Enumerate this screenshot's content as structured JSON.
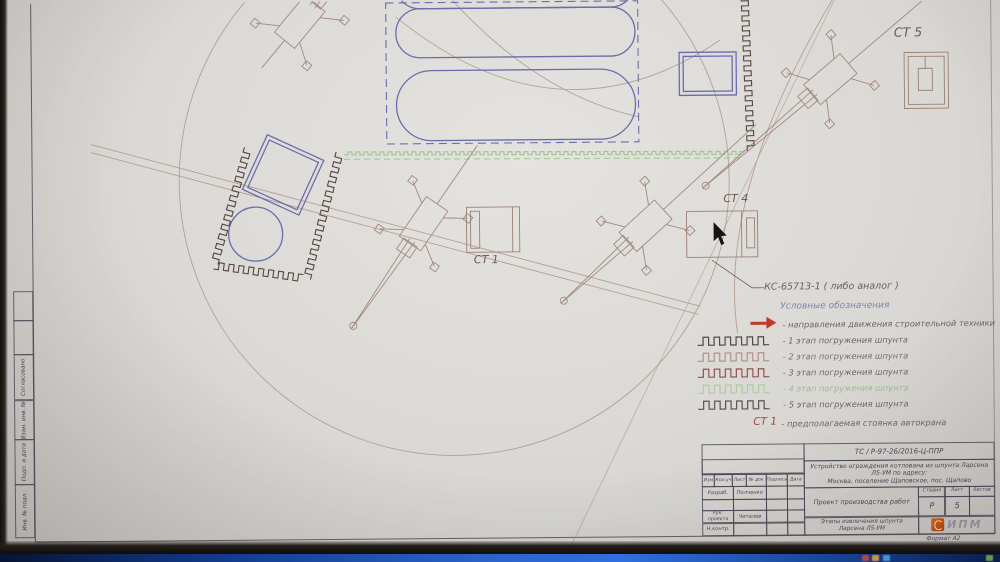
{
  "stations": {
    "st1": "СТ 1",
    "st4": "СТ 4",
    "st5": "СТ 5"
  },
  "crane_callout": "КС-65713-1 ( либо аналог )",
  "legend": {
    "title": "Условные обозначения",
    "direction_label": "- направления движения строительной техники",
    "items": [
      {
        "label": "- 1 этап погружения шпунта",
        "color": "#4f4a47"
      },
      {
        "label": "- 2 этап погружения шпунта",
        "color": "#b5908c"
      },
      {
        "label": "- 3 этап погружения шпунта",
        "color": "#935252"
      },
      {
        "label": "- 4 этап погружения шпунта",
        "color": "#aecba4"
      },
      {
        "label": "- 5 этап погружения шпунта",
        "color": "#5c5356"
      }
    ],
    "station_key": "СТ 1",
    "station_label": "- предполагаемая стоянка автокрана"
  },
  "titleblock": {
    "doc_code": "ТС / Р-97-26/2016-Ц-ППР",
    "project_line1": "Устройство ограждения котлована из шпунта Ларсена Л5-УМ по адресу:",
    "project_line2": "Москва, поселение Щаповское, пос. Щапово",
    "header_cols": [
      "Изм",
      "Кол.уч",
      "Лист",
      "№ док",
      "Подпись",
      "Дата"
    ],
    "rows": [
      {
        "role": "Разраб.",
        "name": "Полченко"
      },
      {
        "role": "",
        "name": ""
      },
      {
        "role": "Рук. проекта",
        "name": "Читалев"
      },
      {
        "role": "Н.контр.",
        "name": ""
      }
    ],
    "doc_type": "Проект производства работ",
    "stage_header": [
      "Стадия",
      "Лист",
      "Листов"
    ],
    "stage": "Р",
    "sheet": "5",
    "sheets": "",
    "sheet_title": "Этапы извлечения шпунта Ларсена Л5-УМ",
    "org": "ИПМ",
    "format_note": "Формат А2"
  },
  "side_stamp": [
    "Согласовано",
    "Взам. инв. №",
    "Подп. и дата",
    "Инв. № подл."
  ],
  "colors": {
    "blueprint_blue": "#6b6dab",
    "plan_sepia": "#ab9084",
    "pile_dark": "#54463e",
    "green_line": "#9cc48c",
    "arrow_red": "#c0392b",
    "taskbar_blue": "#2a62c9",
    "logo_orange": "#d45a1e"
  }
}
